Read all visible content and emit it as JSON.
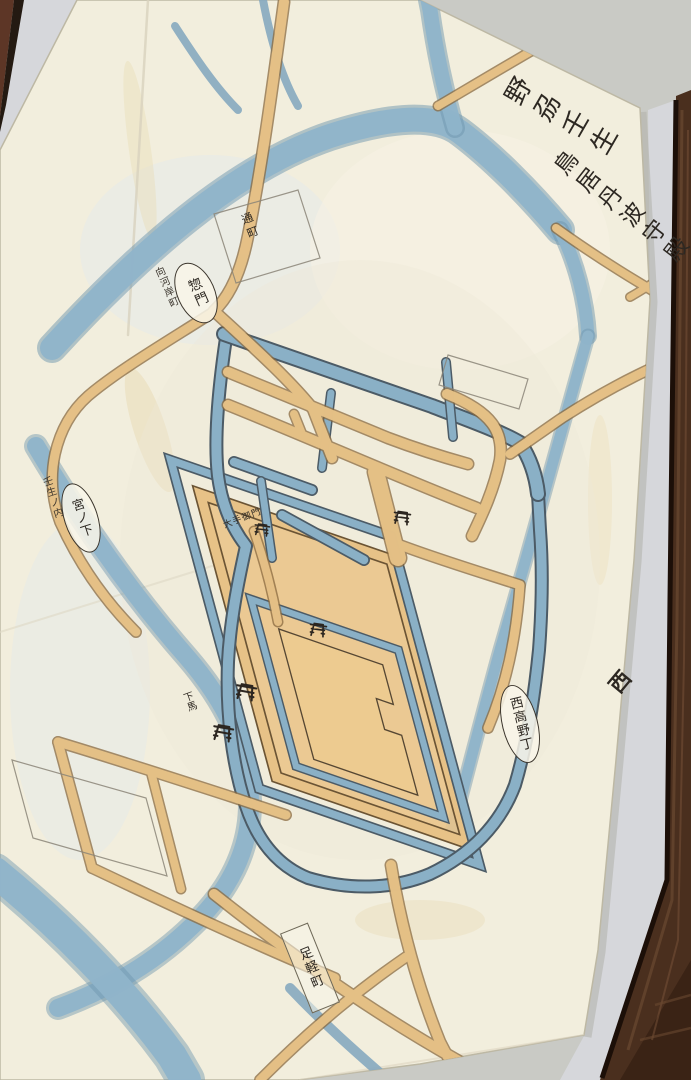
{
  "photo": {
    "frame_color": "#4a2f1e",
    "mat_color": "#d6d7db",
    "paper_color": "#f2eedd"
  },
  "map": {
    "title_col1": "野刕壬生",
    "title_col2": "鳥居丹波守殿",
    "compass_west": "西",
    "cartouche_somon": {
      "text": "惣門",
      "note": "向河岸町"
    },
    "cartouche_miyanoshita": {
      "text": "宮ノ下",
      "note": "壬生ノ内"
    },
    "cartouche_nishitakano": {
      "text": "西高野丁"
    },
    "label_torimachi": "通町",
    "label_ashigarumachi": "足軽町",
    "label_otemon": "大手御門",
    "label_geba": "下馬",
    "colors": {
      "water": "#8fb4ca",
      "road": "#e7c287",
      "ink": "#2d2822"
    }
  }
}
